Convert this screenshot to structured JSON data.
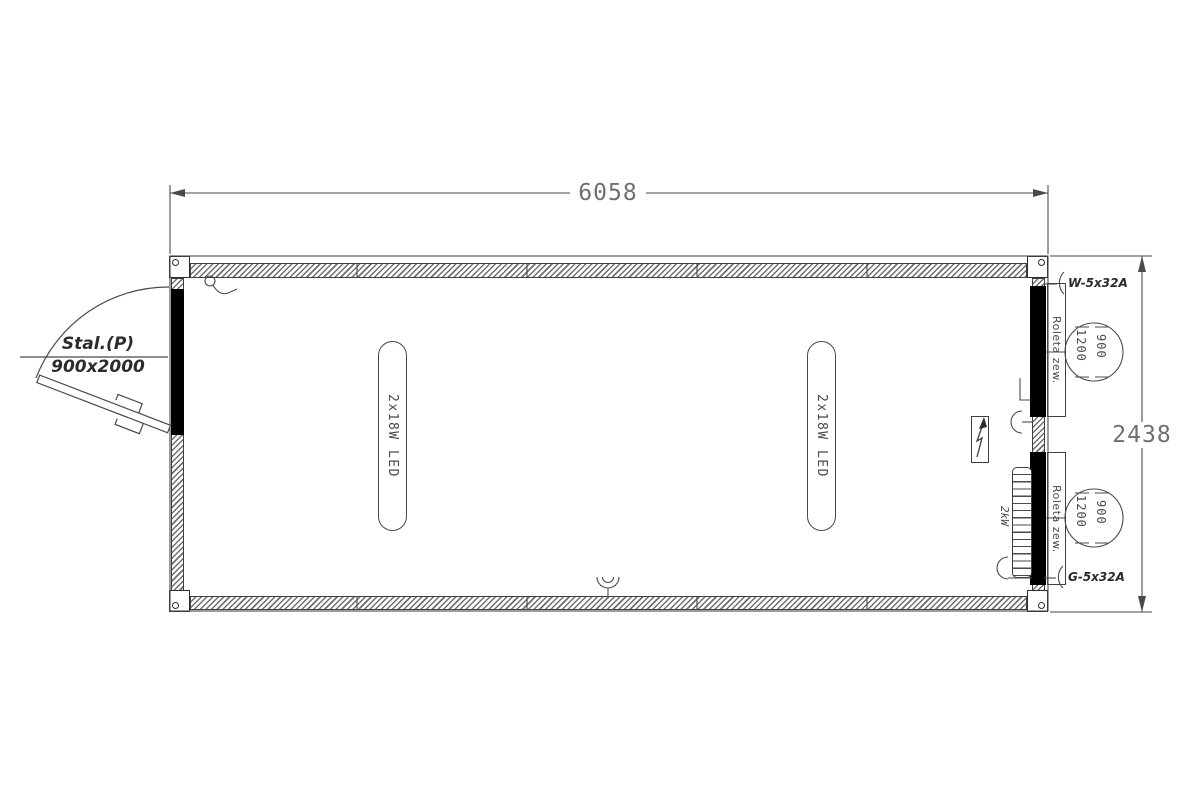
{
  "drawing": {
    "title_context": "container floor plan",
    "dimensions": {
      "total_width": "6058",
      "total_height": "2438"
    },
    "door": {
      "type_label": "Stal.(P)",
      "size_label": "900x2000"
    },
    "lamps": {
      "label": "2x18W LED",
      "count": 2
    },
    "windows": {
      "blind_label": "Roleta zew.",
      "dim_width": "900",
      "dim_offset": "1200"
    },
    "electrical": {
      "feed_label": "W-5x32A",
      "socket_circuit_label": "G-5x32A",
      "heater_label": "2kW"
    },
    "colors": {
      "line": "#3f3f3f",
      "dim_text": "#6f6f6f",
      "fill": "#000000",
      "background": "#ffffff"
    }
  }
}
